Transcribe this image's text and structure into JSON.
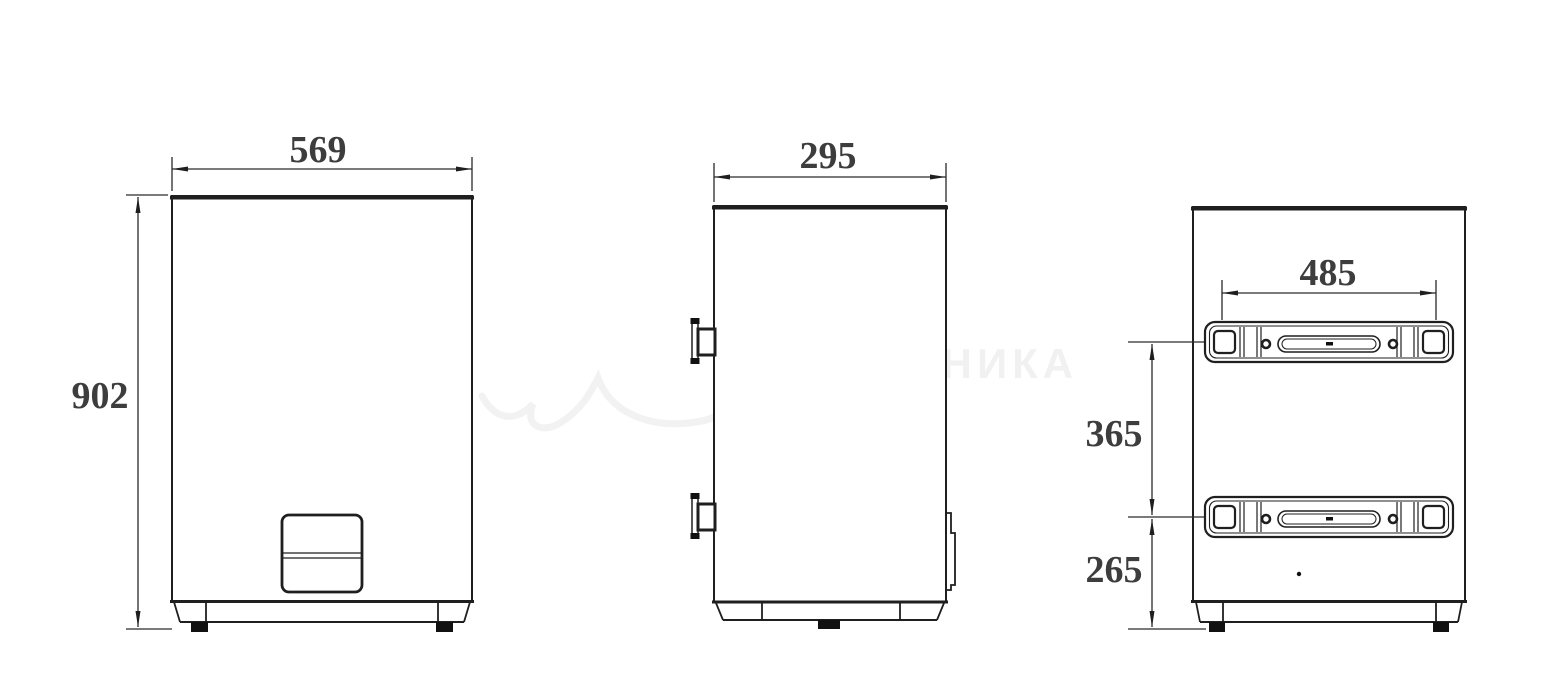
{
  "drawing": {
    "title": "water-heater-three-view-dimension-drawing",
    "views": {
      "front": {
        "width_mm": "569",
        "height_mm": "902"
      },
      "side": {
        "depth_mm": "295"
      },
      "back": {
        "bracket_width_mm": "485",
        "bracket_spacing_mm": "365",
        "bottom_offset_mm": "265"
      }
    },
    "watermark": {
      "line1": "САНТЕХНИКА",
      "line2": "ОНЛАЙН"
    },
    "colors": {
      "background": "#ffffff",
      "line": "#1f1f1f",
      "dimension_text": "#3d3d3d",
      "watermark": "#f1f1f1"
    }
  }
}
